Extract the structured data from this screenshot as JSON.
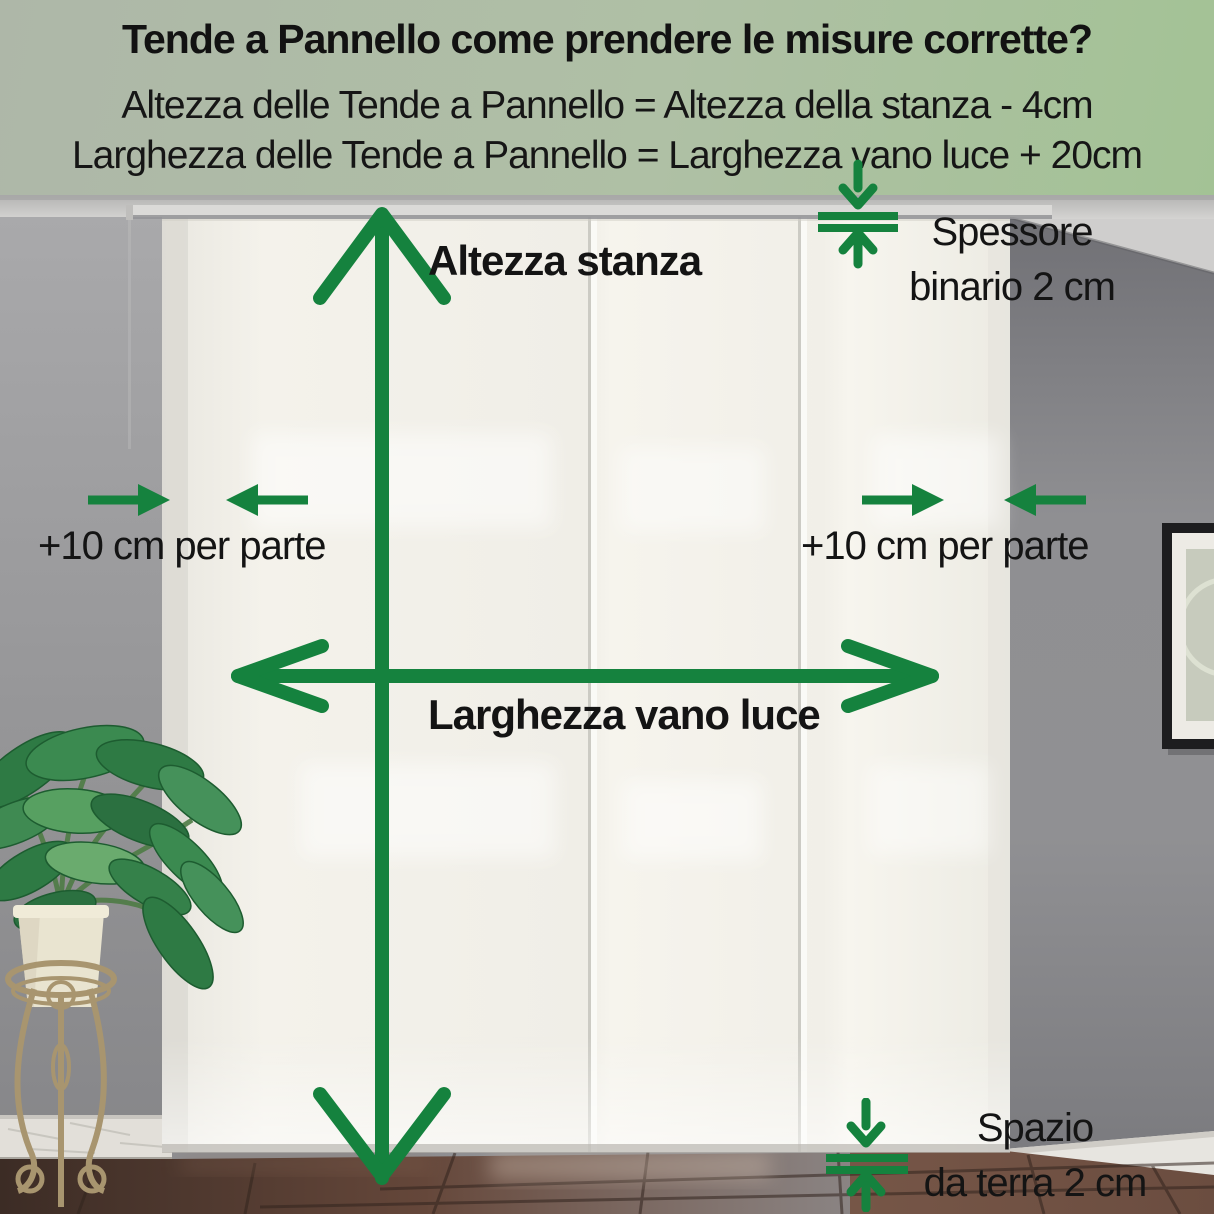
{
  "header": {
    "title": "Tende a Pannello come prendere le misure corrette?",
    "formula_height": "Altezza delle Tende a Pannello = Altezza della stanza - 4cm",
    "formula_width": "Larghezza delle Tende a Pannello = Larghezza vano luce + 20cm"
  },
  "annotations": {
    "room_height": "Altezza stanza",
    "window_width": "Larghezza vano luce",
    "side_allowance_left": "+10 cm per parte",
    "side_allowance_right": "+10 cm per parte",
    "track_thickness_line1": "Spessore",
    "track_thickness_line2": "binario 2 cm",
    "floor_gap_line1": "Spazio",
    "floor_gap_line2": "da terra 2 cm"
  },
  "icons": {
    "vertical_double_arrow": "↕",
    "horizontal_double_arrow": "↔",
    "track_thickness_gauge": "⇵",
    "floor_gap_gauge": "⇵",
    "side_gap_arrows": "→ ←"
  },
  "colors": {
    "accent_green": "#15823e",
    "header_bg_left": "#aeb7a8",
    "header_bg_right": "#a3c295",
    "text": "#141414",
    "curtain": "#f3f1ea",
    "wall_left": "#9a9a9c",
    "wall_right": "#85858a",
    "floor_brown": "#5e4538"
  }
}
